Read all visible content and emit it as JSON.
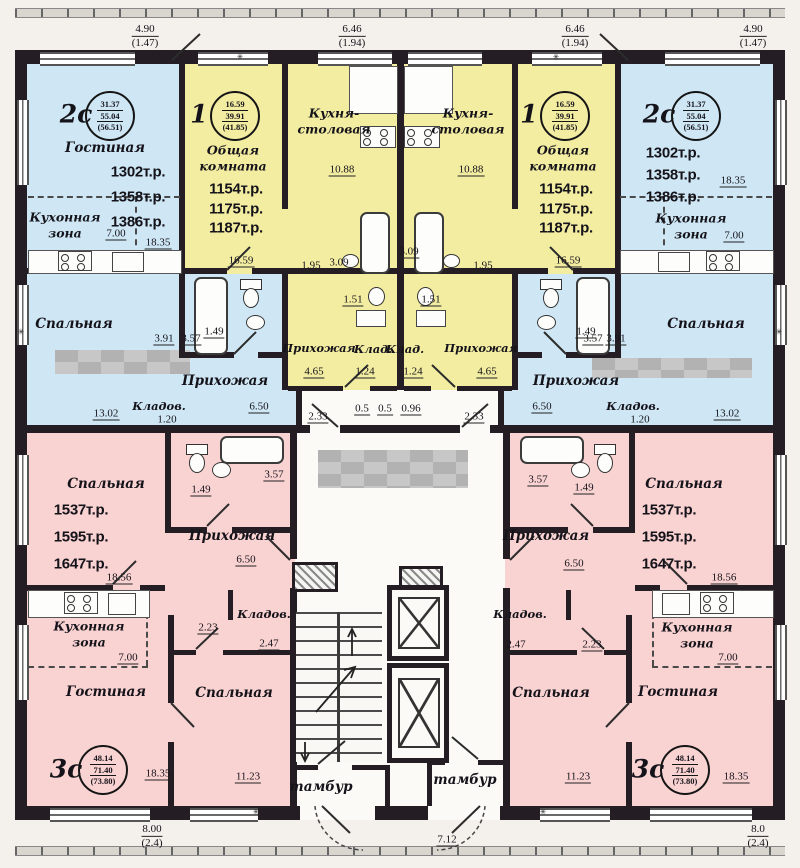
{
  "colors": {
    "blue": "#cfe7f5",
    "yellow": "#f3eda2",
    "pink": "#f9d2d2",
    "wall": "#241e24"
  },
  "top_dims": {
    "d1v": "4.90",
    "d1p": "(1.47)",
    "d2v": "6.46",
    "d2p": "(1.94)",
    "d3v": "6.46",
    "d3p": "(1.94)",
    "d4v": "4.90",
    "d4p": "(1.47)"
  },
  "bottom_dims": {
    "lv": "8.00",
    "lp": "(2.4)",
    "c": "7.12",
    "rv": "8.0",
    "rp": "(2.4)"
  },
  "apt2c": {
    "type": "2с",
    "area_top": "31.37",
    "area_mid": "55.04",
    "area_bot": "(56.51)",
    "price1": "1302т.р.",
    "price2": "1358т.р.",
    "price3": "1386т.р.",
    "living": "Гостиная",
    "kitchen_line1": "Кухонная",
    "kitchen_line2": "зона",
    "bedroom": "Спальная",
    "hall": "Прихожая",
    "storage": "Кладов.",
    "dim_kitchen": "7.00",
    "dim_living": "18.35",
    "dim_bedroom": "13.02",
    "dim_storage": "1.20",
    "dim_391": "3.91",
    "dim_357": "3.57",
    "dim_hall": "6.50",
    "dim_149": "1.49"
  },
  "apt1": {
    "type": "1",
    "area_top": "16.59",
    "area_mid": "39.91",
    "area_bot": "(41.85)",
    "price1": "1154т.р.",
    "price2": "1175т.р.",
    "price3": "1187т.р.",
    "room_line1": "Общая",
    "room_line2": "комната",
    "kd_line1": "Кухня-",
    "kd_line2": "столовая",
    "hall": "Прихожая",
    "storage": "Клад.",
    "dim_room": "16.59",
    "dim_kd": "10.88",
    "dim_195": "1.95",
    "dim_309": "3.09",
    "dim_151": "1.51",
    "dim_465": "4.65",
    "dim_124": "1.24"
  },
  "apt3c": {
    "type": "3с",
    "area_top": "48.14",
    "area_mid": "71.40",
    "area_bot": "(73.80)",
    "price1": "1537т.р.",
    "price2": "1595т.р.",
    "price3": "1647т.р.",
    "bedroom1": "Спальная",
    "dim_bedroom1": "18.56",
    "hall": "Прихожая",
    "dim_hall": "6.50",
    "kitchen_line1": "Кухонная",
    "kitchen_line2": "зона",
    "dim_kitchen": "7.00",
    "living": "Гостиная",
    "dim_living": "18.35",
    "storage": "Кладов.",
    "dim_storage": "2.47",
    "dim_223": "2.23",
    "bedroom2": "Спальная",
    "dim_bedroom2": "11.23",
    "dim_149": "1.49",
    "dim_357": "3.57"
  },
  "core": {
    "vestibule": "тамбур",
    "dim_05": "0.5",
    "dim_096": "0.96",
    "dim_233": "2.33"
  }
}
